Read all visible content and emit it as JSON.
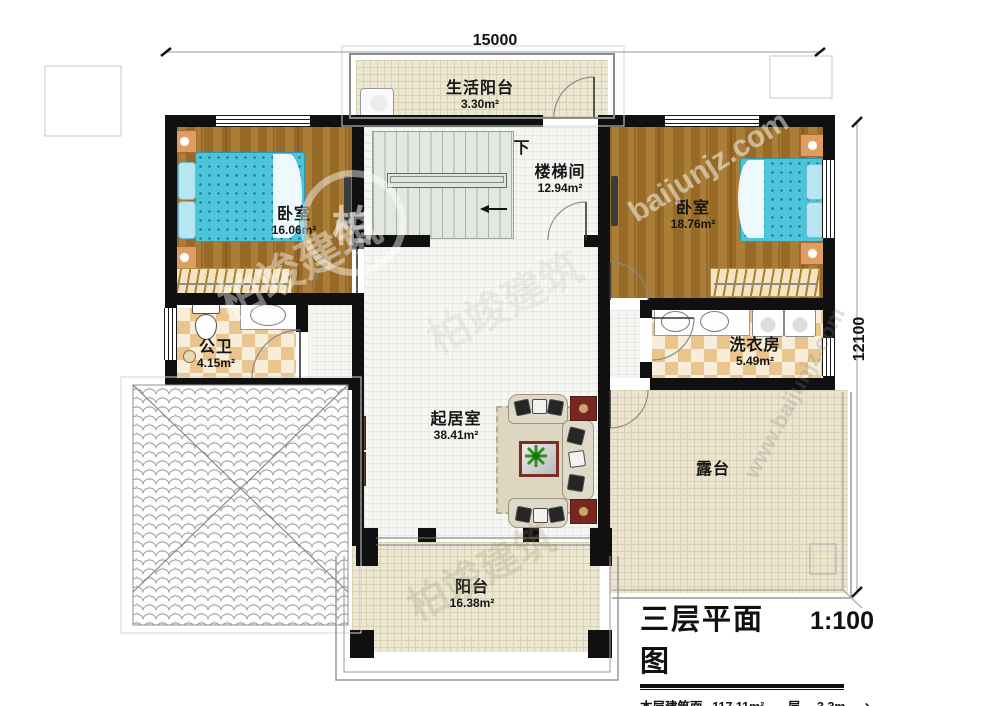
{
  "plan": {
    "dim_top": "15000",
    "dim_right": "12100",
    "rooms": {
      "life_balcony": {
        "name": "生活阳台",
        "area": "3.30m²"
      },
      "stairwell": {
        "name": "楼梯间",
        "area": "12.94m²",
        "down": "下"
      },
      "bedroom_left": {
        "name": "卧室",
        "area": "16.06m²"
      },
      "bedroom_right": {
        "name": "卧室",
        "area": "18.76m²"
      },
      "bathroom": {
        "name": "公卫",
        "area": "4.15m²"
      },
      "laundry": {
        "name": "洗衣房",
        "area": "5.49m²"
      },
      "living": {
        "name": "起居室",
        "area": "38.41m²"
      },
      "terrace": {
        "name": "露台"
      },
      "balcony": {
        "name": "阳台",
        "area": "16.38m²"
      }
    },
    "title_block": {
      "title": "三层平面图",
      "scale": "1:100",
      "area_label": "本层建筑面积:",
      "area_value": "117.11m²",
      "floor_height_label": "层高:",
      "floor_height_value": "3.3m",
      "arrow": "↘"
    },
    "watermark": {
      "brand": "柏竣建筑",
      "brand_char": "柏",
      "site": "baijunjz.com",
      "site_www": "www.baijunjz.com"
    }
  }
}
